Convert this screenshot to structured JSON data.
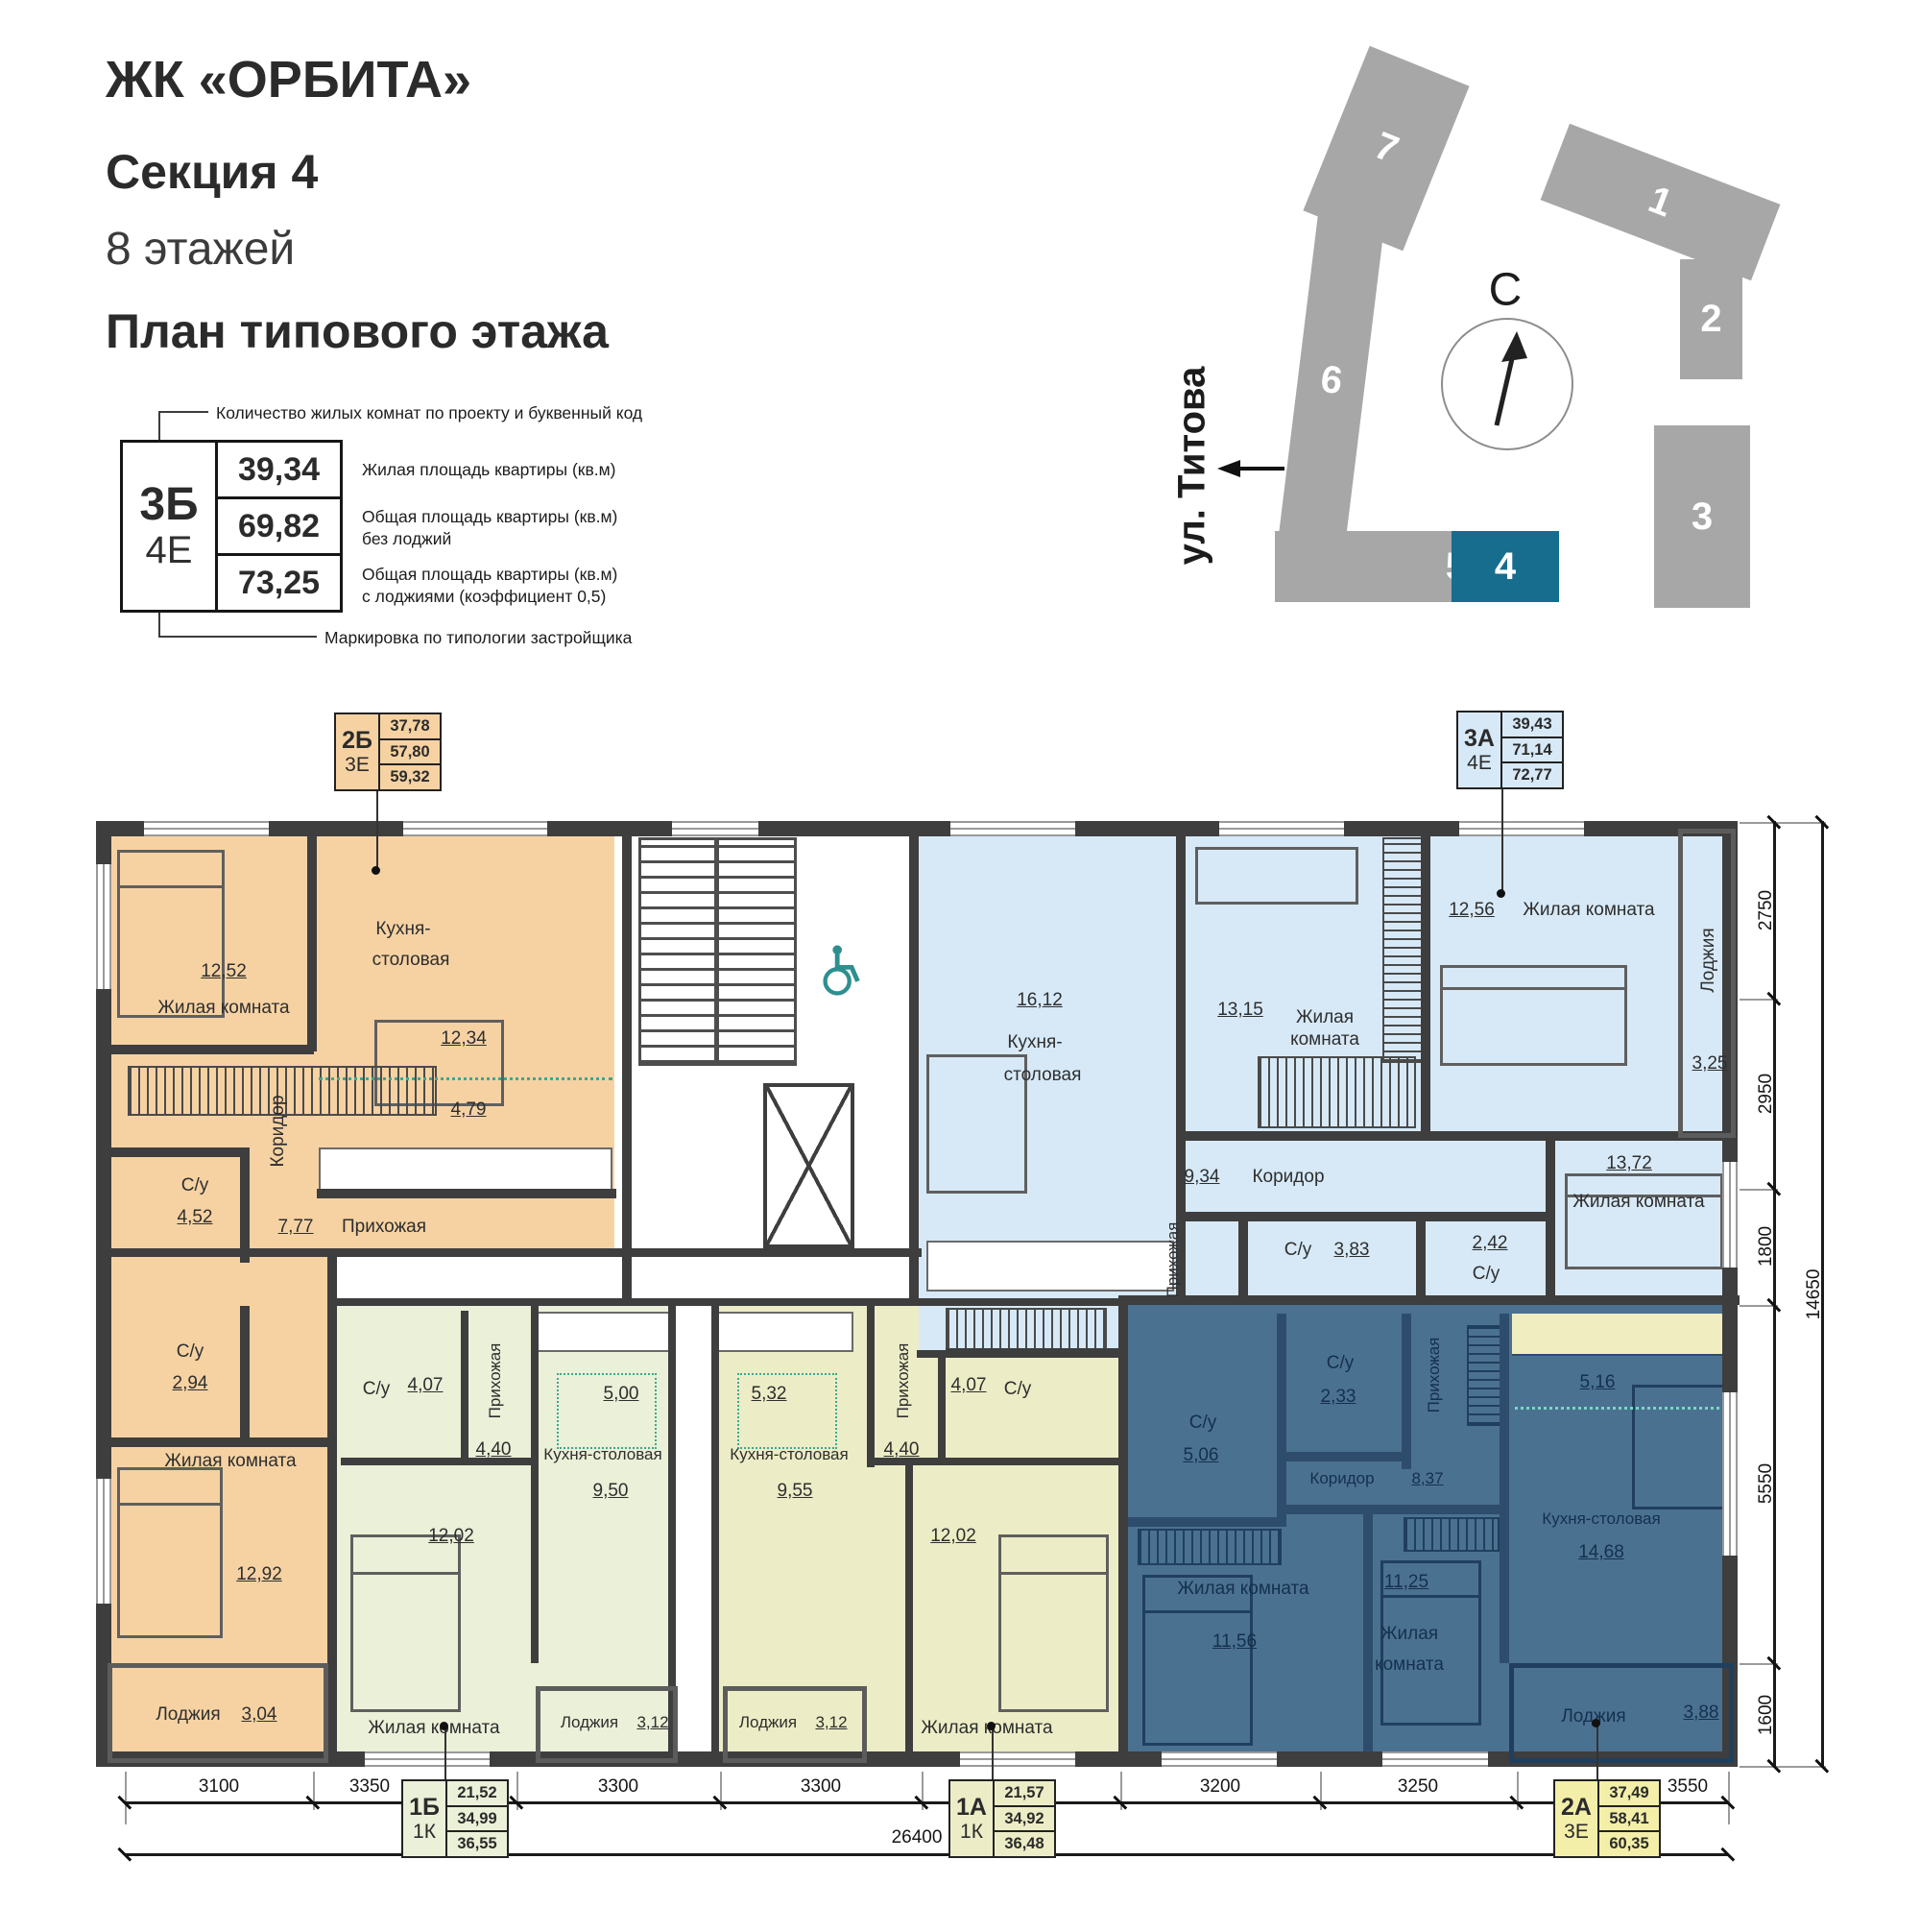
{
  "header": {
    "title": "ЖК «ОРБИТА»",
    "section": "Секция 4",
    "floors": "8 этажей",
    "plan_title": "План типового этажа"
  },
  "legend": {
    "callout_top": "Количество жилых комнат по проекту и буквенный код",
    "code": "3Б",
    "code_type": "4Е",
    "v1": "39,34",
    "v2": "69,82",
    "v3": "73,25",
    "a1": "Жилая площадь квартиры (кв.м)",
    "a2a": "Общая площадь квартиры (кв.м)",
    "a2b": "без лоджий",
    "a3a": "Общая площадь квартиры (кв.м)",
    "a3b": "с лоджиями (коэффициент 0,5)",
    "callout_bottom": "Маркировка по типологии застройщика"
  },
  "site": {
    "north": "С",
    "street": "ул. Титова",
    "buildings": {
      "b1": "1",
      "b2": "2",
      "b3": "3",
      "b4": "4",
      "b5": "5",
      "b6": "6",
      "b7": "7"
    }
  },
  "plan": {
    "apartments": {
      "a2b": {
        "code": "2Б",
        "type": "3Е",
        "living": "37,78",
        "no_loggia": "57,80",
        "total": "59,32"
      },
      "a3a": {
        "code": "3А",
        "type": "4Е",
        "living": "39,43",
        "no_loggia": "71,14",
        "total": "72,77"
      },
      "a1b": {
        "code": "1Б",
        "type": "1К",
        "living": "21,52",
        "no_loggia": "34,99",
        "total": "36,55"
      },
      "a1a": {
        "code": "1А",
        "type": "1К",
        "living": "21,57",
        "no_loggia": "34,92",
        "total": "36,48"
      },
      "a2a": {
        "code": "2А",
        "type": "3Е",
        "living": "37,49",
        "no_loggia": "58,41",
        "total": "60,35"
      }
    },
    "rooms": {
      "orange": {
        "bed1_area": "12,52",
        "bed1_name": "Жилая комната",
        "kitchen_name1": "Кухня-",
        "kitchen_name2": "столовая",
        "kitchen_area": "12,34",
        "kitchen_zone": "4,79",
        "corridor_name": "Коридор",
        "corridor_area": "7,77",
        "wc1_name": "С/у",
        "wc1_area": "4,52",
        "hall_name": "Прихожая",
        "wc2_name": "С/у",
        "wc2_area": "2,94",
        "bed2_name": "Жилая комната",
        "bed2_area": "12,92",
        "loggia_name": "Лоджия",
        "loggia_area": "3,04"
      },
      "blue": {
        "kitchen_area": "16,12",
        "kitchen_name1": "Кухня-",
        "kitchen_name2": "столовая",
        "bed1_area": "13,15",
        "bed1_name": "Жилая комната",
        "bed2_area": "12,56",
        "bed2_name": "Жилая комната",
        "loggia_name": "Лоджия",
        "loggia_area": "3,25",
        "corridor_area": "9,34",
        "corridor_name": "Коридор",
        "hall_name": "Прихожая",
        "wc1_name": "С/у",
        "wc1_area": "3,83",
        "wc2_area": "2,42",
        "wc2_name": "С/у",
        "bed3_area": "13,72",
        "bed3_name": "Жилая комната"
      },
      "green": {
        "wc_name": "С/у",
        "wc_area": "4,07",
        "hall_name": "Прихожая",
        "hall_area": "4,40",
        "kitchen_zone": "5,00",
        "kitchen_name": "Кухня-столовая",
        "kitchen_area": "9,50",
        "bed_area": "12,02",
        "bed_name": "Жилая комната",
        "loggia_name": "Лоджия",
        "loggia_area": "3,12"
      },
      "olive": {
        "kitchen_zone": "5,32",
        "kitchen_name": "Кухня-столовая",
        "kitchen_area": "9,55",
        "hall_name": "Прихожая",
        "hall_area": "4,40",
        "wc_area": "4,07",
        "wc_name": "С/у",
        "bed_area": "12,02",
        "bed_name": "Жилая комната",
        "loggia_name": "Лоджия",
        "loggia_area": "3,12"
      },
      "navy": {
        "wc1_name": "С/у",
        "wc1_area": "5,06",
        "wc2_name": "С/у",
        "wc2_area": "2,33",
        "hall_name": "Прихожая",
        "corridor_name": "Коридор",
        "corridor_area": "8,37",
        "kitchen_zone": "5,16",
        "kitchen_name": "Кухня-столовая",
        "kitchen_area": "14,68",
        "bed1_name": "Жилая комната",
        "bed1_area": "11,56",
        "bed2_area": "11,25",
        "bed2_name1": "Жилая",
        "bed2_name2": "комната",
        "loggia_name": "Лоджия",
        "loggia_area": "3,88"
      }
    },
    "dims": {
      "bottom": [
        "3100",
        "3350",
        "3300",
        "3300",
        "3200",
        "3250",
        "3550"
      ],
      "bottom_total": "26400",
      "right": [
        "2750",
        "2950",
        "1800",
        "5550",
        "1600"
      ],
      "right_total": "14650"
    }
  },
  "colors": {
    "orange": "#f6d2a3",
    "blue": "#d7e9f7",
    "green": "#ebf0d8",
    "olive": "#ecedc6",
    "navy": "#4b7191",
    "accent": "#176d8e"
  }
}
